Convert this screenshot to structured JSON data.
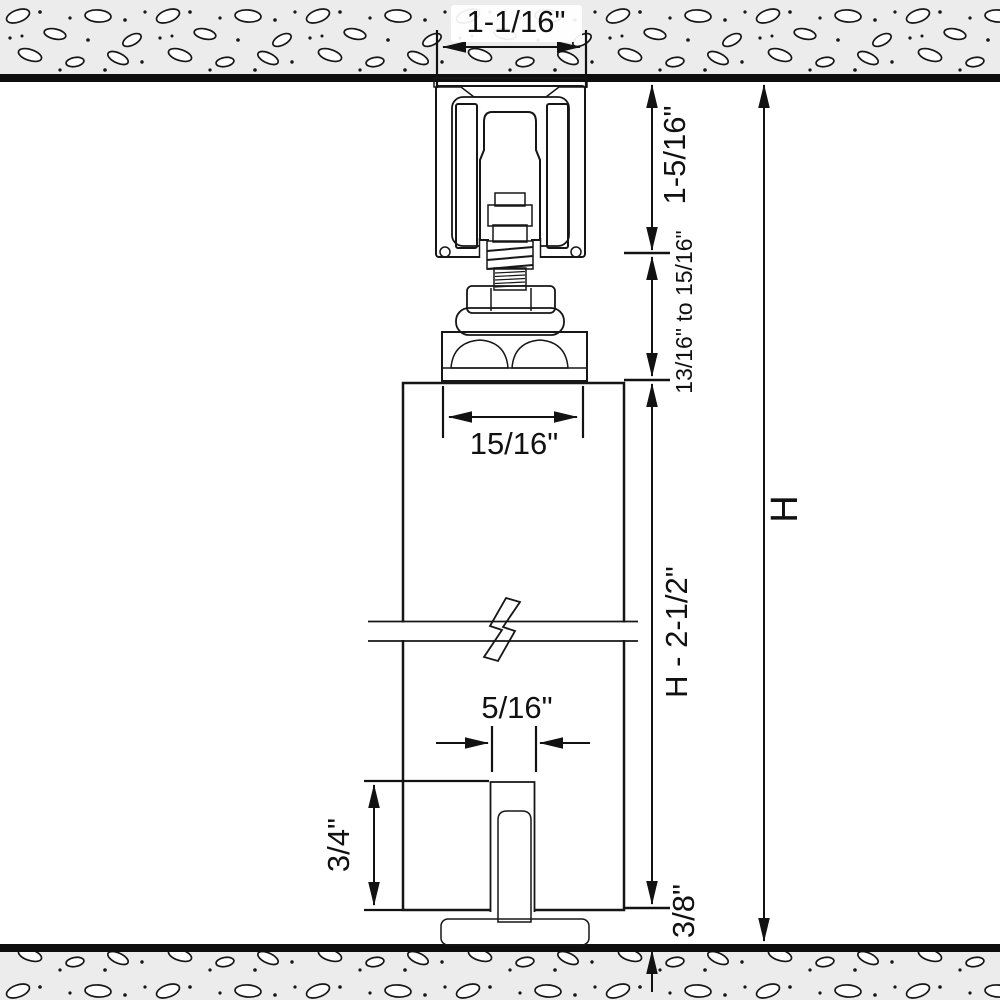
{
  "drawing": {
    "description": "Cross-section of top-hung sliding door roller hardware between ceiling and floor, with installation dimensions",
    "dimensions": {
      "track_width": "1-1/16\"",
      "track_height": "1-5/16\"",
      "adjustment_range": "13/16\" to 15/16\"",
      "hanger_plate_width": "15/16\"",
      "door_height": "H - 2-1/2\"",
      "guide_groove_width": "5/16\"",
      "guide_groove_depth": "3/4\"",
      "floor_clearance": "3/8\"",
      "opening_height": "H"
    },
    "colors": {
      "wood": "#d1b083",
      "roller_yellow": "#f5e112",
      "metal_silver": "#c9c9cd",
      "wheel_dark": "#46464a",
      "guide_dark": "#3e3e43",
      "concrete": "#ececec",
      "line": "#111111"
    }
  }
}
